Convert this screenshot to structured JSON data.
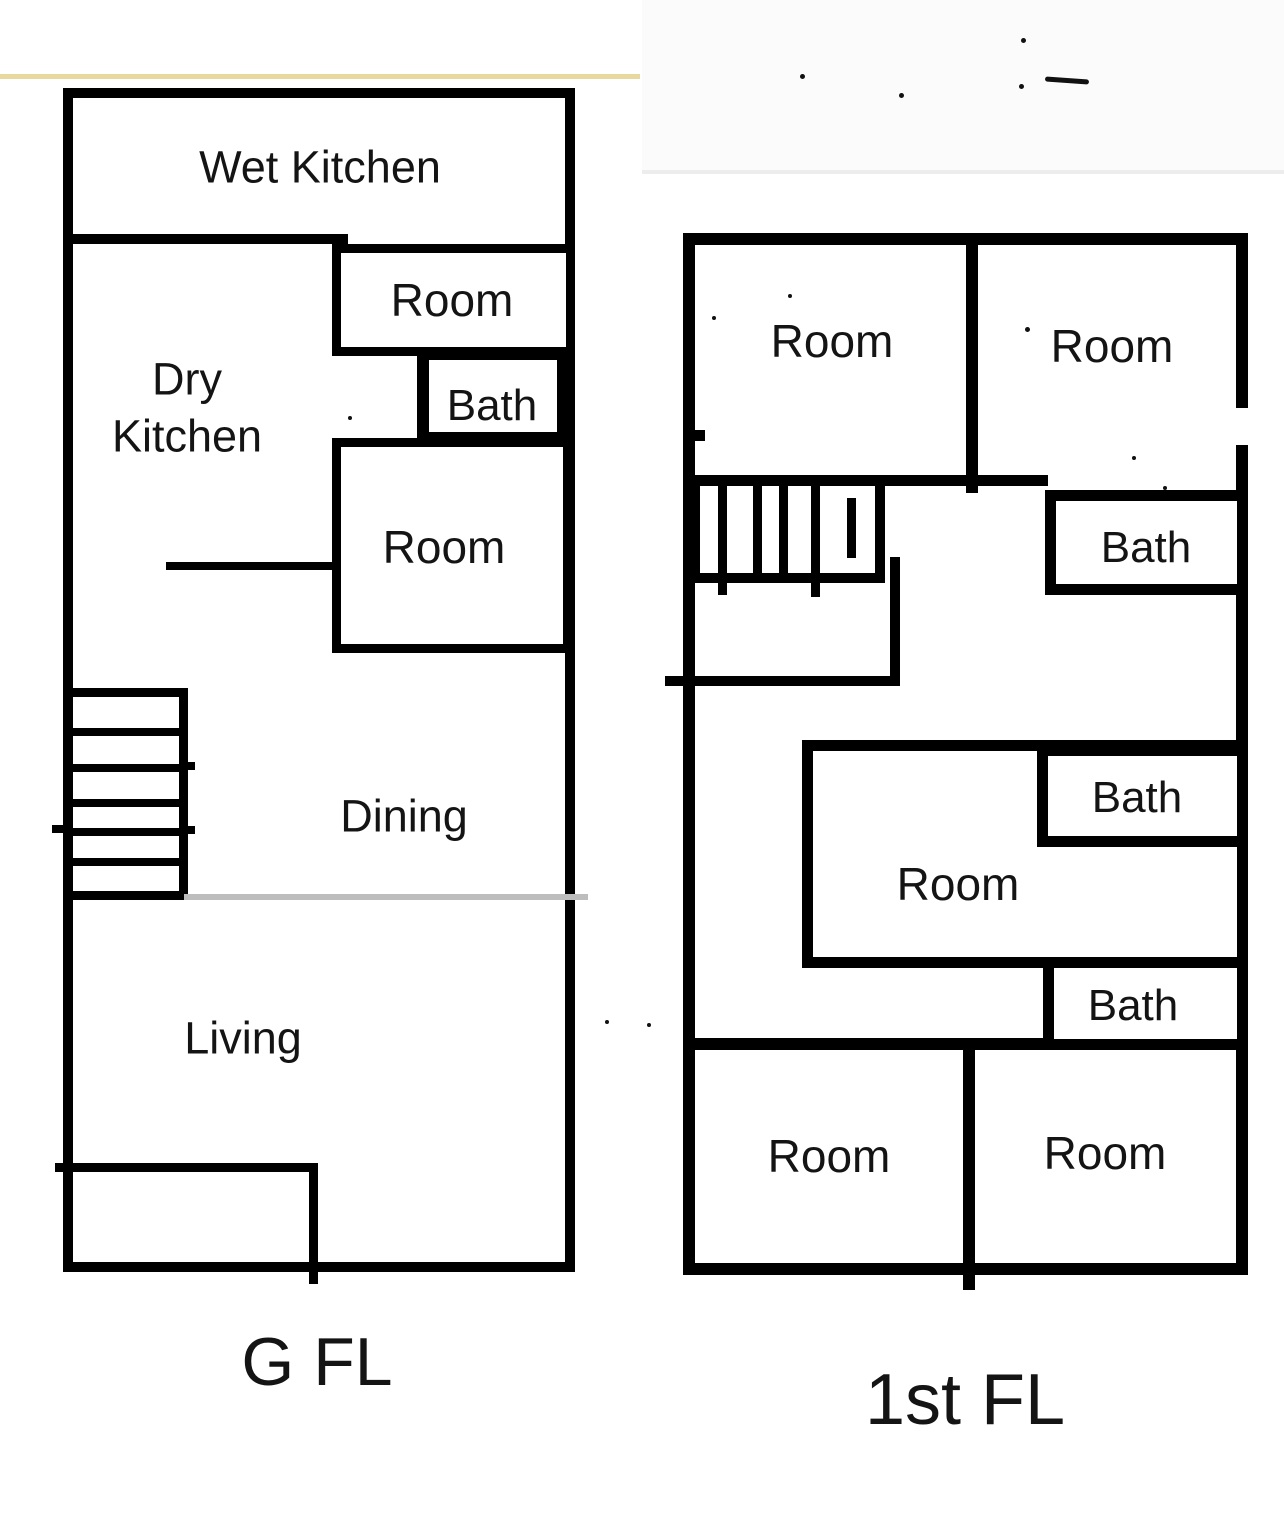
{
  "figure": {
    "type": "floor-plan",
    "floor_count": 2
  },
  "gfl": {
    "title": "G FL",
    "wet_kitchen": "Wet Kitchen",
    "room_top": "Room",
    "dry_line1": "Dry",
    "dry_line2": "Kitchen",
    "bath": "Bath",
    "room_mid": "Room",
    "dining": "Dining",
    "living": "Living"
  },
  "ffl": {
    "title": "1st FL",
    "room_top_left": "Room",
    "room_top_right": "Room",
    "bath_upper": "Bath",
    "room_middle": "Room",
    "bath_middle": "Bath",
    "bath_lower": "Bath",
    "room_bottom_left": "Room",
    "room_bottom_right": "Room"
  },
  "colors": {
    "wall": "#000000",
    "accent_top_line": "#e8d8a0",
    "gray_divider": "#bdbdbd",
    "background": "#ffffff"
  }
}
